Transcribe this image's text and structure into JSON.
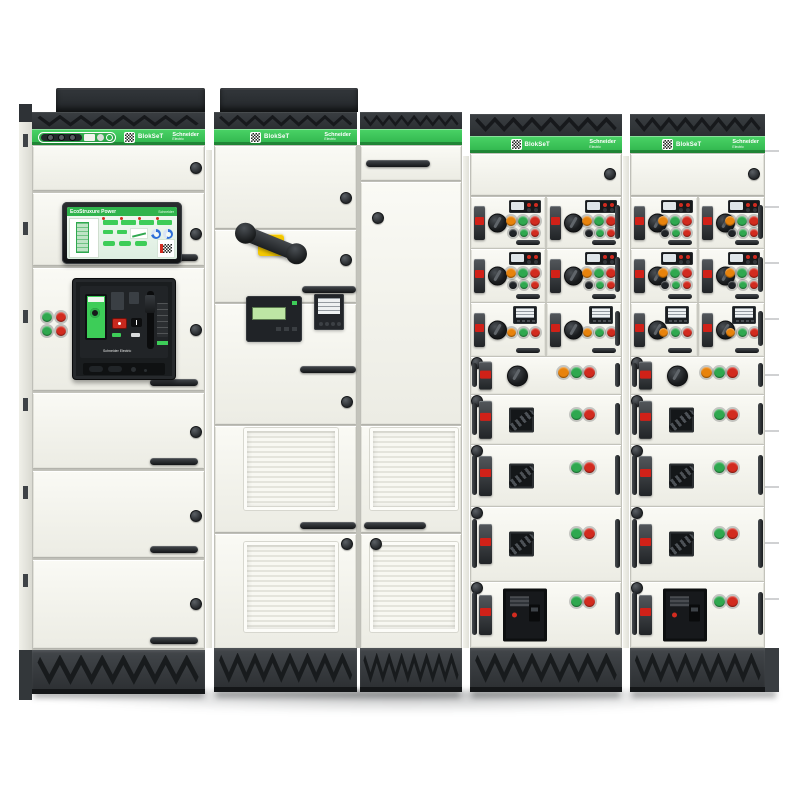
{
  "scene": {
    "background": "#ffffff"
  },
  "brand": {
    "product_name": "BlokSeT",
    "manufacturer": "Schneider Electric",
    "logo_line1": "Schneider",
    "logo_line2": "Electric"
  },
  "hmi": {
    "title": "EcoStruxure Power"
  },
  "colors": {
    "brand_green": "#3DCD58",
    "button_red": "#D22B1F",
    "button_green": "#2FA84F",
    "button_orange": "#E8830C",
    "button_black": "#202428",
    "handle_yellow": "#F2C400",
    "gauge_blue": "#2E6FD8"
  },
  "cabinet1_pushbuttons": [
    "green",
    "red",
    "green",
    "red"
  ],
  "mcc_rows": [
    {
      "type": "pair",
      "style": "starter",
      "top_buttons": [
        "orange",
        "green",
        "red"
      ],
      "bottom_buttons": [
        "black",
        "green",
        "red"
      ]
    },
    {
      "type": "pair",
      "style": "starter",
      "top_buttons": [
        "orange",
        "green",
        "red"
      ],
      "bottom_buttons": [
        "black",
        "green",
        "red"
      ]
    },
    {
      "type": "pair",
      "style": "meter",
      "buttons": [
        "orange",
        "green",
        "red"
      ]
    },
    {
      "type": "wide",
      "style": "rotary",
      "buttons": [
        "orange",
        "green",
        "red"
      ]
    },
    {
      "type": "wide",
      "style": "lever",
      "buttons": [
        "green",
        "red"
      ]
    },
    {
      "type": "wide",
      "style": "lever",
      "buttons": [
        "green",
        "red"
      ]
    },
    {
      "type": "wide",
      "style": "lever",
      "buttons": [
        "green",
        "red"
      ]
    },
    {
      "type": "wide",
      "style": "mccb",
      "buttons": [
        "green",
        "red"
      ]
    }
  ]
}
